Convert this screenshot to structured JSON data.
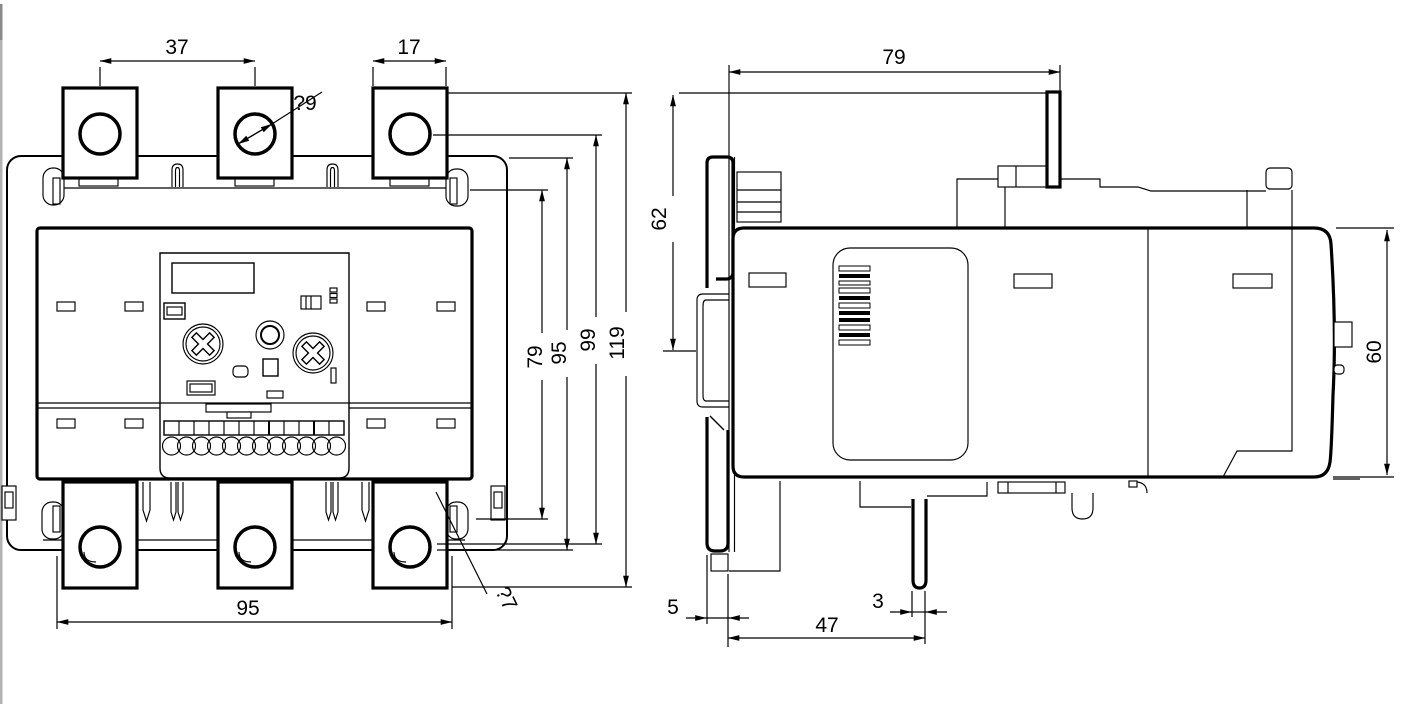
{
  "colors": {
    "line": "#000000",
    "background": "#ffffff",
    "edge_strip": "#b3b3b3"
  },
  "front_view": {
    "name": "front view",
    "dimensions": {
      "terminal_pitch": "37",
      "terminal_width": "17",
      "hole_dia_top": "?9",
      "height_79": "79",
      "height_95": "95",
      "height_99": "99",
      "height_119": "119",
      "terminal_span": "95",
      "hole_dia_bottom": "?7"
    }
  },
  "side_view": {
    "name": "side view",
    "dimensions": {
      "depth": "79",
      "rail_drop": "62",
      "body_height": "60",
      "clip_depth": "5",
      "pin_offset": "47",
      "pin_width": "3"
    }
  }
}
